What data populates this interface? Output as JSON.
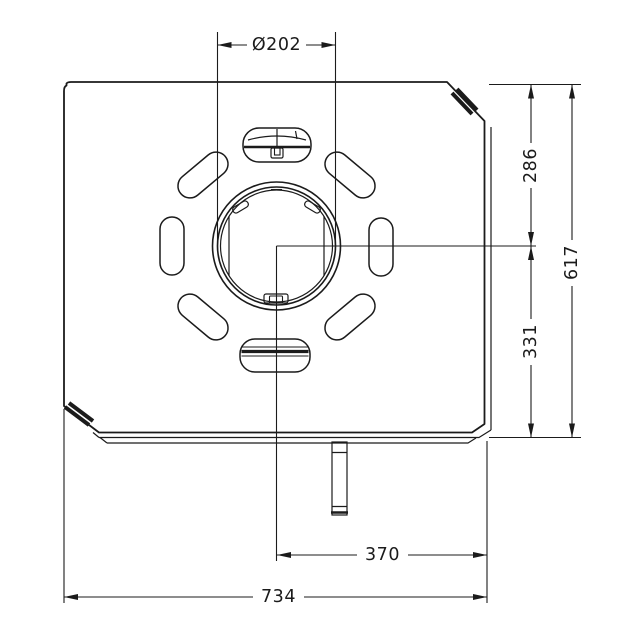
{
  "page": {
    "background_color": "#ffffff",
    "line_color": "#1b1b1b"
  },
  "drawing": {
    "kind": "technical dimension drawing, top view of mounting plate with central round opening, eight slot cutouts and bottom stem",
    "dimensions": {
      "hole_diameter": "Ø202",
      "top_to_center": "286",
      "center_to_bottom": "331",
      "overall_height": "617",
      "center_to_right_edge": "370",
      "overall_width": "734"
    }
  }
}
